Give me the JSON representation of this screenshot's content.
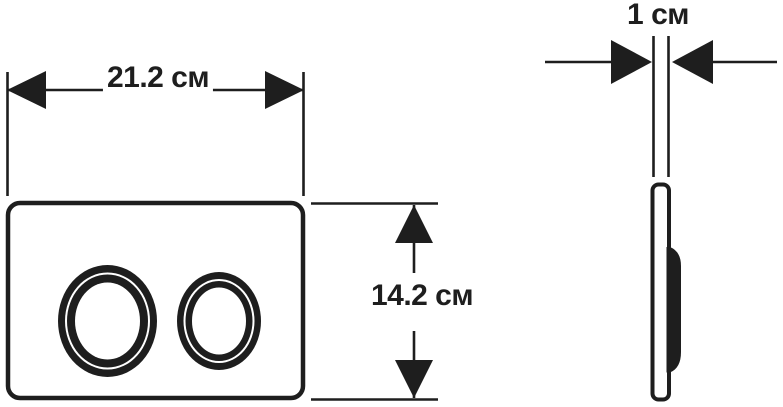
{
  "canvas": {
    "background": "#ffffff",
    "ink": "#1e1e1e"
  },
  "dimensions": {
    "width_label": "21.2 см",
    "height_label": "14.2 см",
    "depth_label": "1 см"
  }
}
